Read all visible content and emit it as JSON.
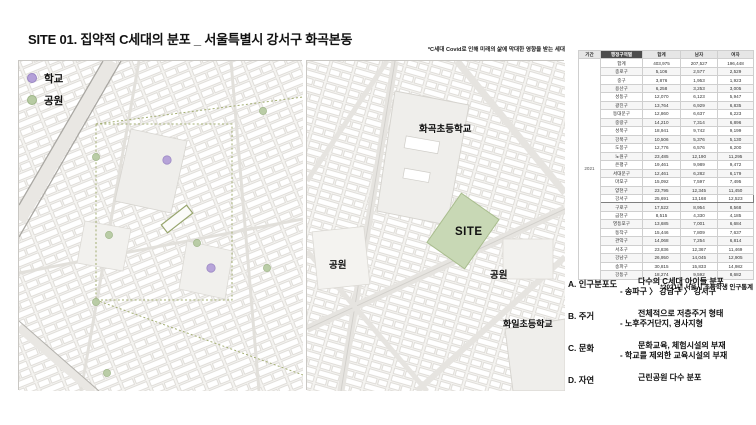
{
  "title": "SITE 01. 집약적 C세대의 분포 _ 서울특별시 강서구 화곡본동",
  "note": "*C세대 Covid로 인해 미래의 삶에 막대한 영향을 받는 세대",
  "legend": {
    "school": "학교",
    "park": "공원"
  },
  "middle_map": {
    "school_top": "화곡초등학교",
    "site": "SITE",
    "park_left": "공원",
    "park_right": "공원",
    "school_bottom": "화일초등학교"
  },
  "table": {
    "caption": "*2021년 서울시 초등학생 인구통계",
    "period": "2021",
    "columns": [
      "기간",
      "행정구역별",
      "합계",
      "남자",
      "여자"
    ],
    "highlight_row": "강서구",
    "rows": [
      [
        "합계",
        "403,975",
        "207,527",
        "196,448"
      ],
      [
        "종로구",
        "5,106",
        "2,577",
        "2,529"
      ],
      [
        "중구",
        "3,876",
        "1,953",
        "1,923"
      ],
      [
        "용산구",
        "6,258",
        "3,253",
        "3,005"
      ],
      [
        "성동구",
        "12,070",
        "6,123",
        "5,947"
      ],
      [
        "광진구",
        "13,764",
        "6,929",
        "6,835"
      ],
      [
        "동대문구",
        "12,860",
        "6,637",
        "6,223"
      ],
      [
        "중랑구",
        "14,210",
        "7,314",
        "6,896"
      ],
      [
        "성북구",
        "18,941",
        "9,742",
        "9,199"
      ],
      [
        "강북구",
        "10,506",
        "5,376",
        "5,130"
      ],
      [
        "도봉구",
        "12,776",
        "6,576",
        "6,200"
      ],
      [
        "노원구",
        "23,485",
        "12,190",
        "11,295"
      ],
      [
        "은평구",
        "19,461",
        "9,989",
        "9,472"
      ],
      [
        "서대문구",
        "12,461",
        "6,282",
        "6,179"
      ],
      [
        "마포구",
        "15,092",
        "7,597",
        "7,495"
      ],
      [
        "양천구",
        "23,795",
        "12,345",
        "11,450"
      ],
      [
        "강서구",
        "25,691",
        "13,168",
        "12,523"
      ],
      [
        "구로구",
        "17,522",
        "8,954",
        "8,568"
      ],
      [
        "금천구",
        "8,515",
        "4,330",
        "4,185"
      ],
      [
        "영등포구",
        "13,685",
        "7,001",
        "6,684"
      ],
      [
        "동작구",
        "15,446",
        "7,809",
        "7,637"
      ],
      [
        "관악구",
        "14,068",
        "7,254",
        "6,814"
      ],
      [
        "서초구",
        "23,836",
        "12,367",
        "11,469"
      ],
      [
        "강남구",
        "26,950",
        "14,045",
        "12,905"
      ],
      [
        "송파구",
        "30,815",
        "15,833",
        "14,982"
      ],
      [
        "강동구",
        "18,274",
        "9,592",
        "8,682"
      ]
    ]
  },
  "findings": [
    {
      "key": "A.",
      "label": "인구분포도",
      "line1": "다수의 C세대 아이들 분포",
      "line2": "- 송파구 〉 강남구 〉 강서구"
    },
    {
      "key": "B.",
      "label": "주거",
      "line1": "전체적으로 저층주거 형태",
      "line2": "- 노후주거단지, 경사지형"
    },
    {
      "key": "C.",
      "label": "문화",
      "line1": "문화교육, 체험시설의 부재",
      "line2": "- 학교를 제외한 교육시설의 부재"
    },
    {
      "key": "D.",
      "label": "자연",
      "line1": "근린공원 다수 분포",
      "line2": ""
    }
  ],
  "colors": {
    "school": "#b4a0d8",
    "park": "#b7cba3",
    "siteGreen": "#c8d8b5",
    "dashline": "#a2ad72",
    "mapBg": "#f4f3f0",
    "blockStroke": "#d6d3ce",
    "highlightBorder": "#7f7f7f"
  }
}
